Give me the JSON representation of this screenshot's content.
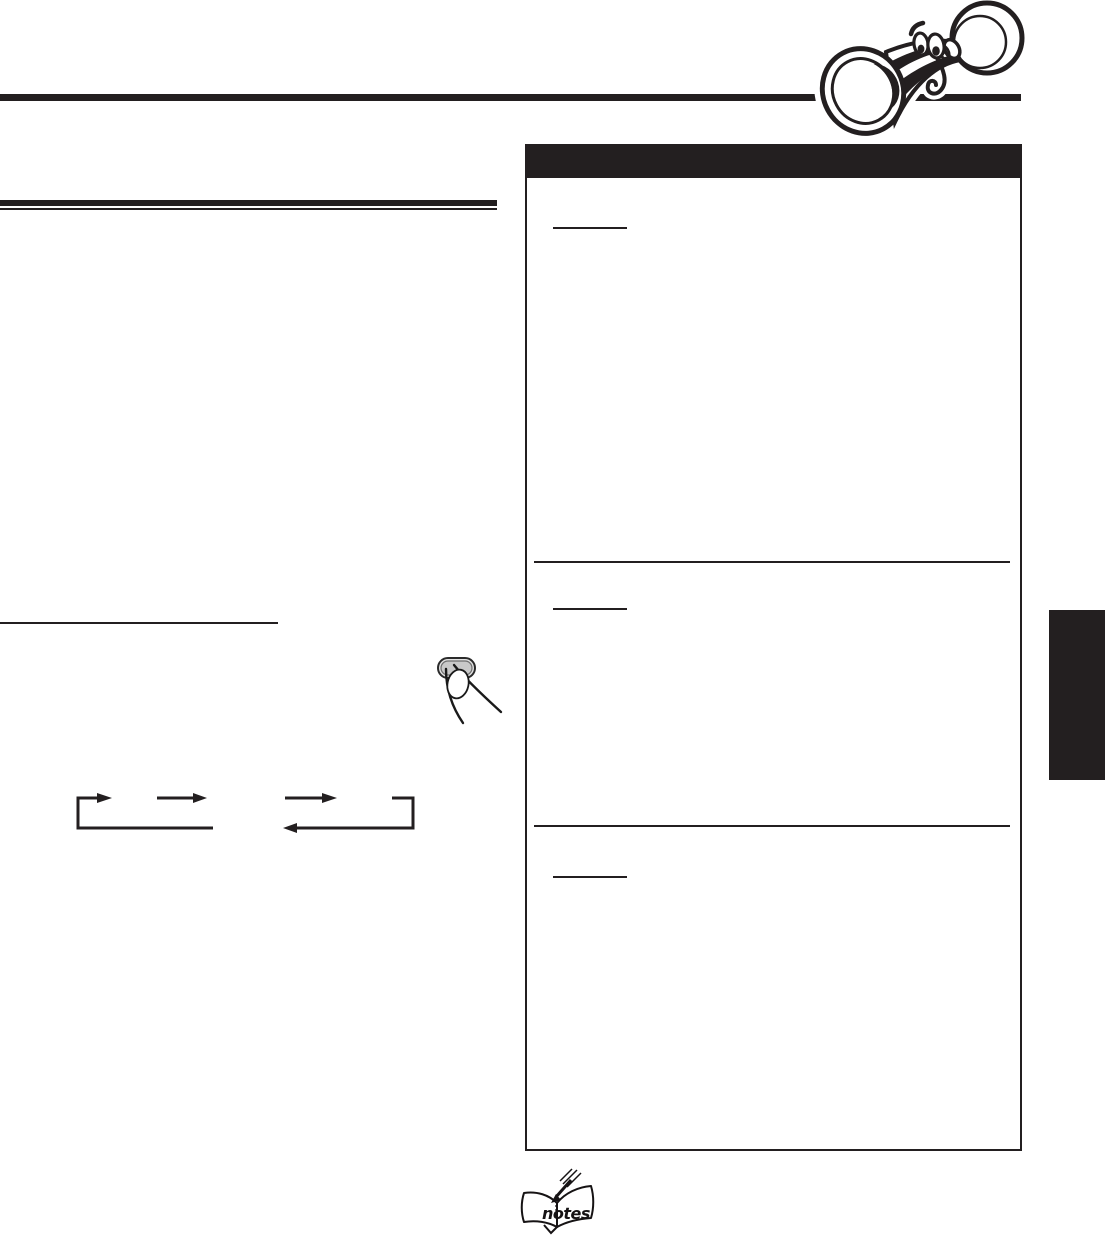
{
  "page": {
    "background": "#ffffff",
    "ink": "#231f20"
  },
  "colors": {
    "ink": "#231f20",
    "button_gray": "#c9c9c9",
    "button_gray_light": "#e3e3e3",
    "button_inner_edge": "#6f6f6f"
  },
  "notes_icon": {
    "label": "notes"
  },
  "icons": {
    "horn": "cartoon-horn-mascot-illustration",
    "finger_button": "finger-pressing-button-illustration",
    "cycle_diagram": "mode-cycle-arrows-diagram",
    "notes": "notes-open-book-icon"
  }
}
